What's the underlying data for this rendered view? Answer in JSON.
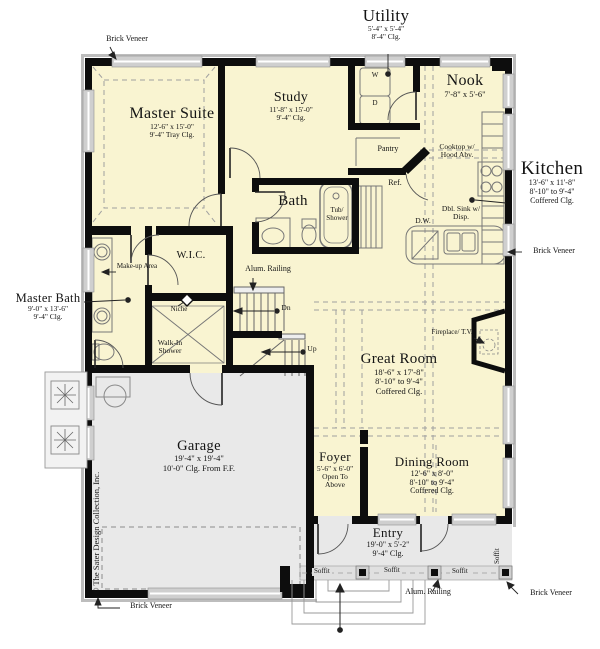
{
  "plan": {
    "rooms": {
      "master_suite": {
        "name": "Master Suite",
        "dims": [
          "12'-6\" x 15'-0\"",
          "9'-4\" Tray Clg."
        ]
      },
      "study": {
        "name": "Study",
        "dims": [
          "11'-8\" x 15'-0\"",
          "9'-4\" Clg."
        ]
      },
      "utility": {
        "name": "Utility",
        "dims": [
          "5'-4\" x 5'-4\"",
          "8'-4\" Clg."
        ]
      },
      "nook": {
        "name": "Nook",
        "dims": [
          "7'-8\" x 5'-6\""
        ]
      },
      "kitchen": {
        "name": "Kitchen",
        "dims": [
          "13'-6\" x 11'-8\"",
          "8'-10\" to 9'-4\"",
          "Coffered Clg."
        ]
      },
      "bath": {
        "name": "Bath"
      },
      "master_bath": {
        "name": "Master Bath",
        "dims": [
          "9'-0\" x 13'-6\"",
          "9'-4\" Clg."
        ]
      },
      "wic": {
        "name": "W.I.C."
      },
      "great_room": {
        "name": "Great Room",
        "dims": [
          "18'-6\" x 17'-8\"",
          "8'-10\" to 9'-4\"",
          "Coffered Clg."
        ]
      },
      "garage": {
        "name": "Garage",
        "dims": [
          "19'-4\" x 19'-4\"",
          "10'-0\" Clg. From F.F."
        ]
      },
      "foyer": {
        "name": "Foyer",
        "dims": [
          "5'-6\" x 6'-0\"",
          "Open To",
          "Above"
        ]
      },
      "dining_room": {
        "name": "Dining Room",
        "dims": [
          "12'-6\" x 8'-0\"",
          "8'-10\" to 9'-4\"",
          "Coffered Clg."
        ]
      },
      "entry": {
        "name": "Entry",
        "dims": [
          "19'-0\" x 5'-2\"",
          "9'-4\" Clg."
        ]
      }
    },
    "features": {
      "washer": "W",
      "dryer": "D",
      "pantry": "Pantry",
      "ref": "Ref.",
      "cooktop": "Cooktop w/ Hood Abv.",
      "dw": "D.W.",
      "dbl_sink": "Dbl. Sink w/ Disp.",
      "tub_shower": "Tub/ Shower",
      "makeup": "Make-up Area",
      "niche": "Niche",
      "walk_in_shower": "Walk-In Shower",
      "fireplace": "Fireplace/ T.V.",
      "dn": "Dn",
      "up": "Up",
      "soffit": "Soffit",
      "alum_railing": "Alum. Railing",
      "brick_veneer": "Brick Veneer"
    },
    "copyright": "© The Sater Design Collection, Inc.",
    "colors": {
      "floor": "#f9f4d1",
      "garage": "#e9e9e9",
      "porch": "#e8e8e8",
      "wall": "#0d0d0d"
    }
  }
}
